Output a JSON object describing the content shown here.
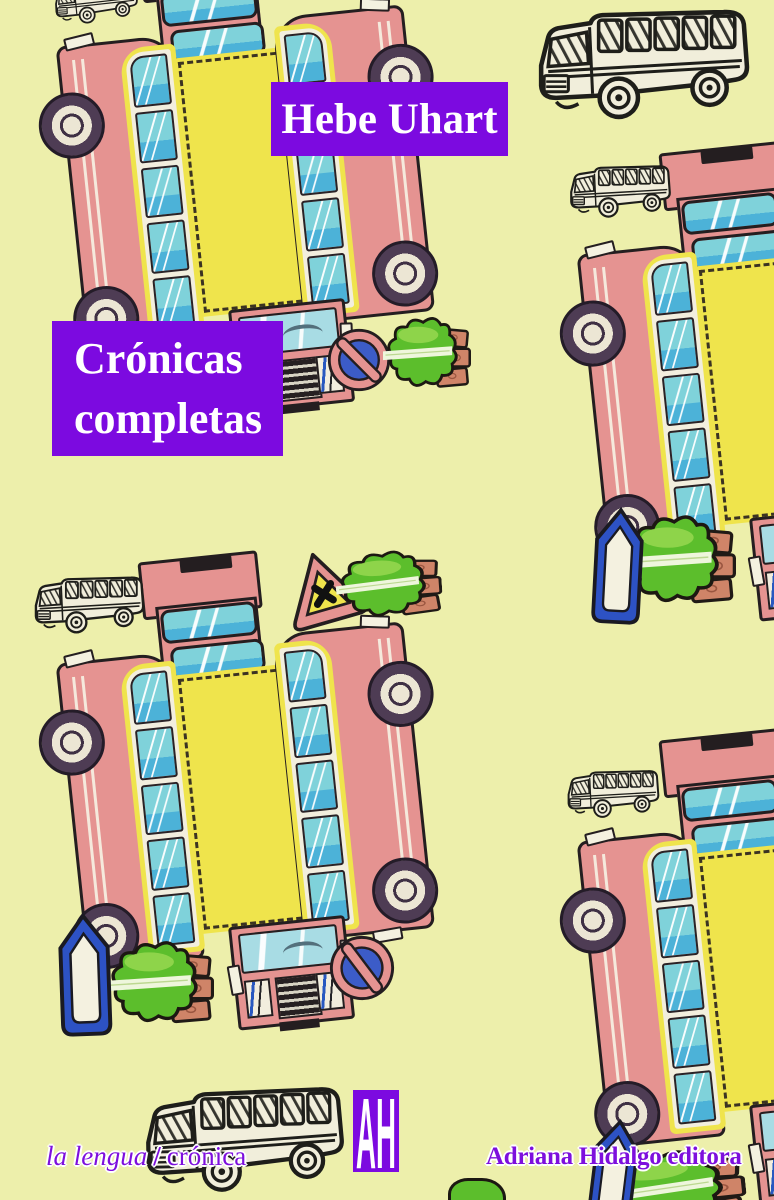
{
  "cover": {
    "author": "Hebe Uhart",
    "title": "Crónicas completas",
    "collection": {
      "series": "la lengua",
      "separator": "/",
      "genre": "crónica"
    },
    "publisher": {
      "logo": "AH",
      "name": "Adriana Hidalgo editora"
    }
  },
  "palette": {
    "background": "#edefab",
    "accent_purple": "#7c0ae0",
    "text_purple": "#7d0fdd",
    "bus_pink": "#e59391",
    "window_teal": "#7fd2da",
    "deep_teal": "#4cb2d8",
    "roof_yellow": "#efe44c",
    "tree_green": "#5cbe2c",
    "boat_blue": "#2d52c4",
    "sign_blue": "#3c5cc8",
    "ink": "#241e20",
    "cream": "#f1eedb"
  },
  "illustrations": {
    "papercraft_bus_templates": 4,
    "sketch_minibuses": 6,
    "no_parking_signs": 2,
    "crossing_signs": 1,
    "hedge_trees": 5,
    "boats": 3
  }
}
